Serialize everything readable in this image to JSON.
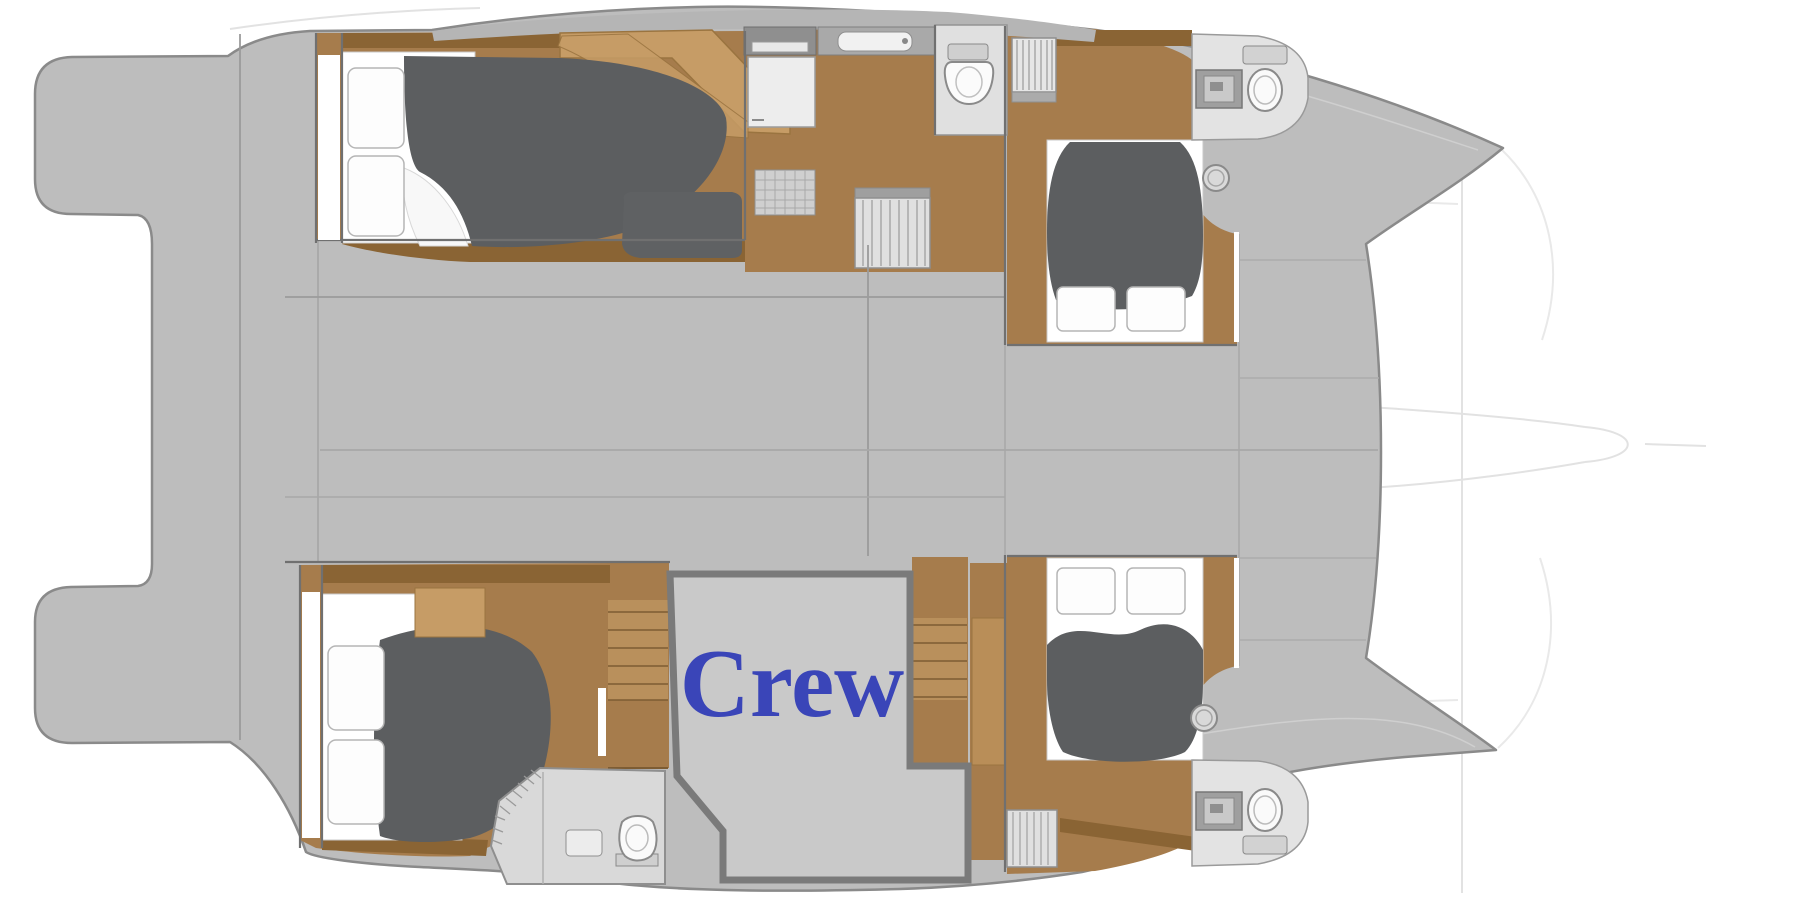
{
  "plan": {
    "crew_label": "Crew",
    "label_color": "#3a45b8",
    "colors": {
      "deck_gray": "#bdbdbd",
      "crew_room_gray": "#c9c9c9",
      "room_border_gray": "#7a7a7a",
      "wood": "#a67c4c",
      "wood_light": "#c69c66",
      "wood_dark": "#8a6434",
      "bedding_gray": "#5c5e60",
      "fixture_white": "#f5f5f5",
      "outline_gray": "#8a8a8a"
    }
  }
}
